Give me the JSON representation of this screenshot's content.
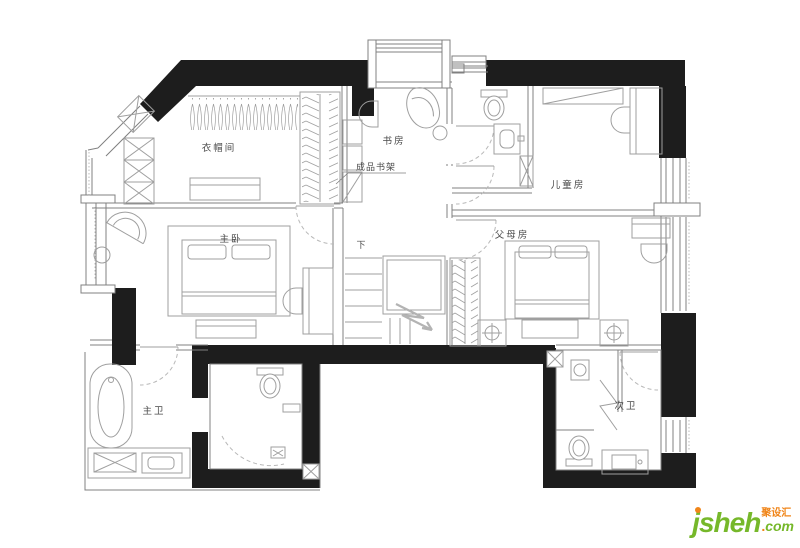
{
  "rooms": {
    "cloakroom": "衣帽间",
    "study": "书房",
    "bookshelf_note": "成品书架",
    "kids_room": "儿童房",
    "master_bedroom": "主卧",
    "parents_room": "父母房",
    "master_bath": "主卫",
    "second_bath": "次卫",
    "stairs_down": "下"
  },
  "logo": {
    "j": "j",
    "rest": "sheh",
    "dot": ".",
    "tld": "com",
    "chinese": "聚设汇",
    "color_green": "#76b82a",
    "color_orange": "#f08519"
  },
  "plan": {
    "wall_color": "#1d1d1d",
    "thin_line_color": "#808080",
    "furniture_color": "#9f9f9f",
    "label_color": "#4a4a4a",
    "door_arc_color": "#b8b8b8"
  }
}
